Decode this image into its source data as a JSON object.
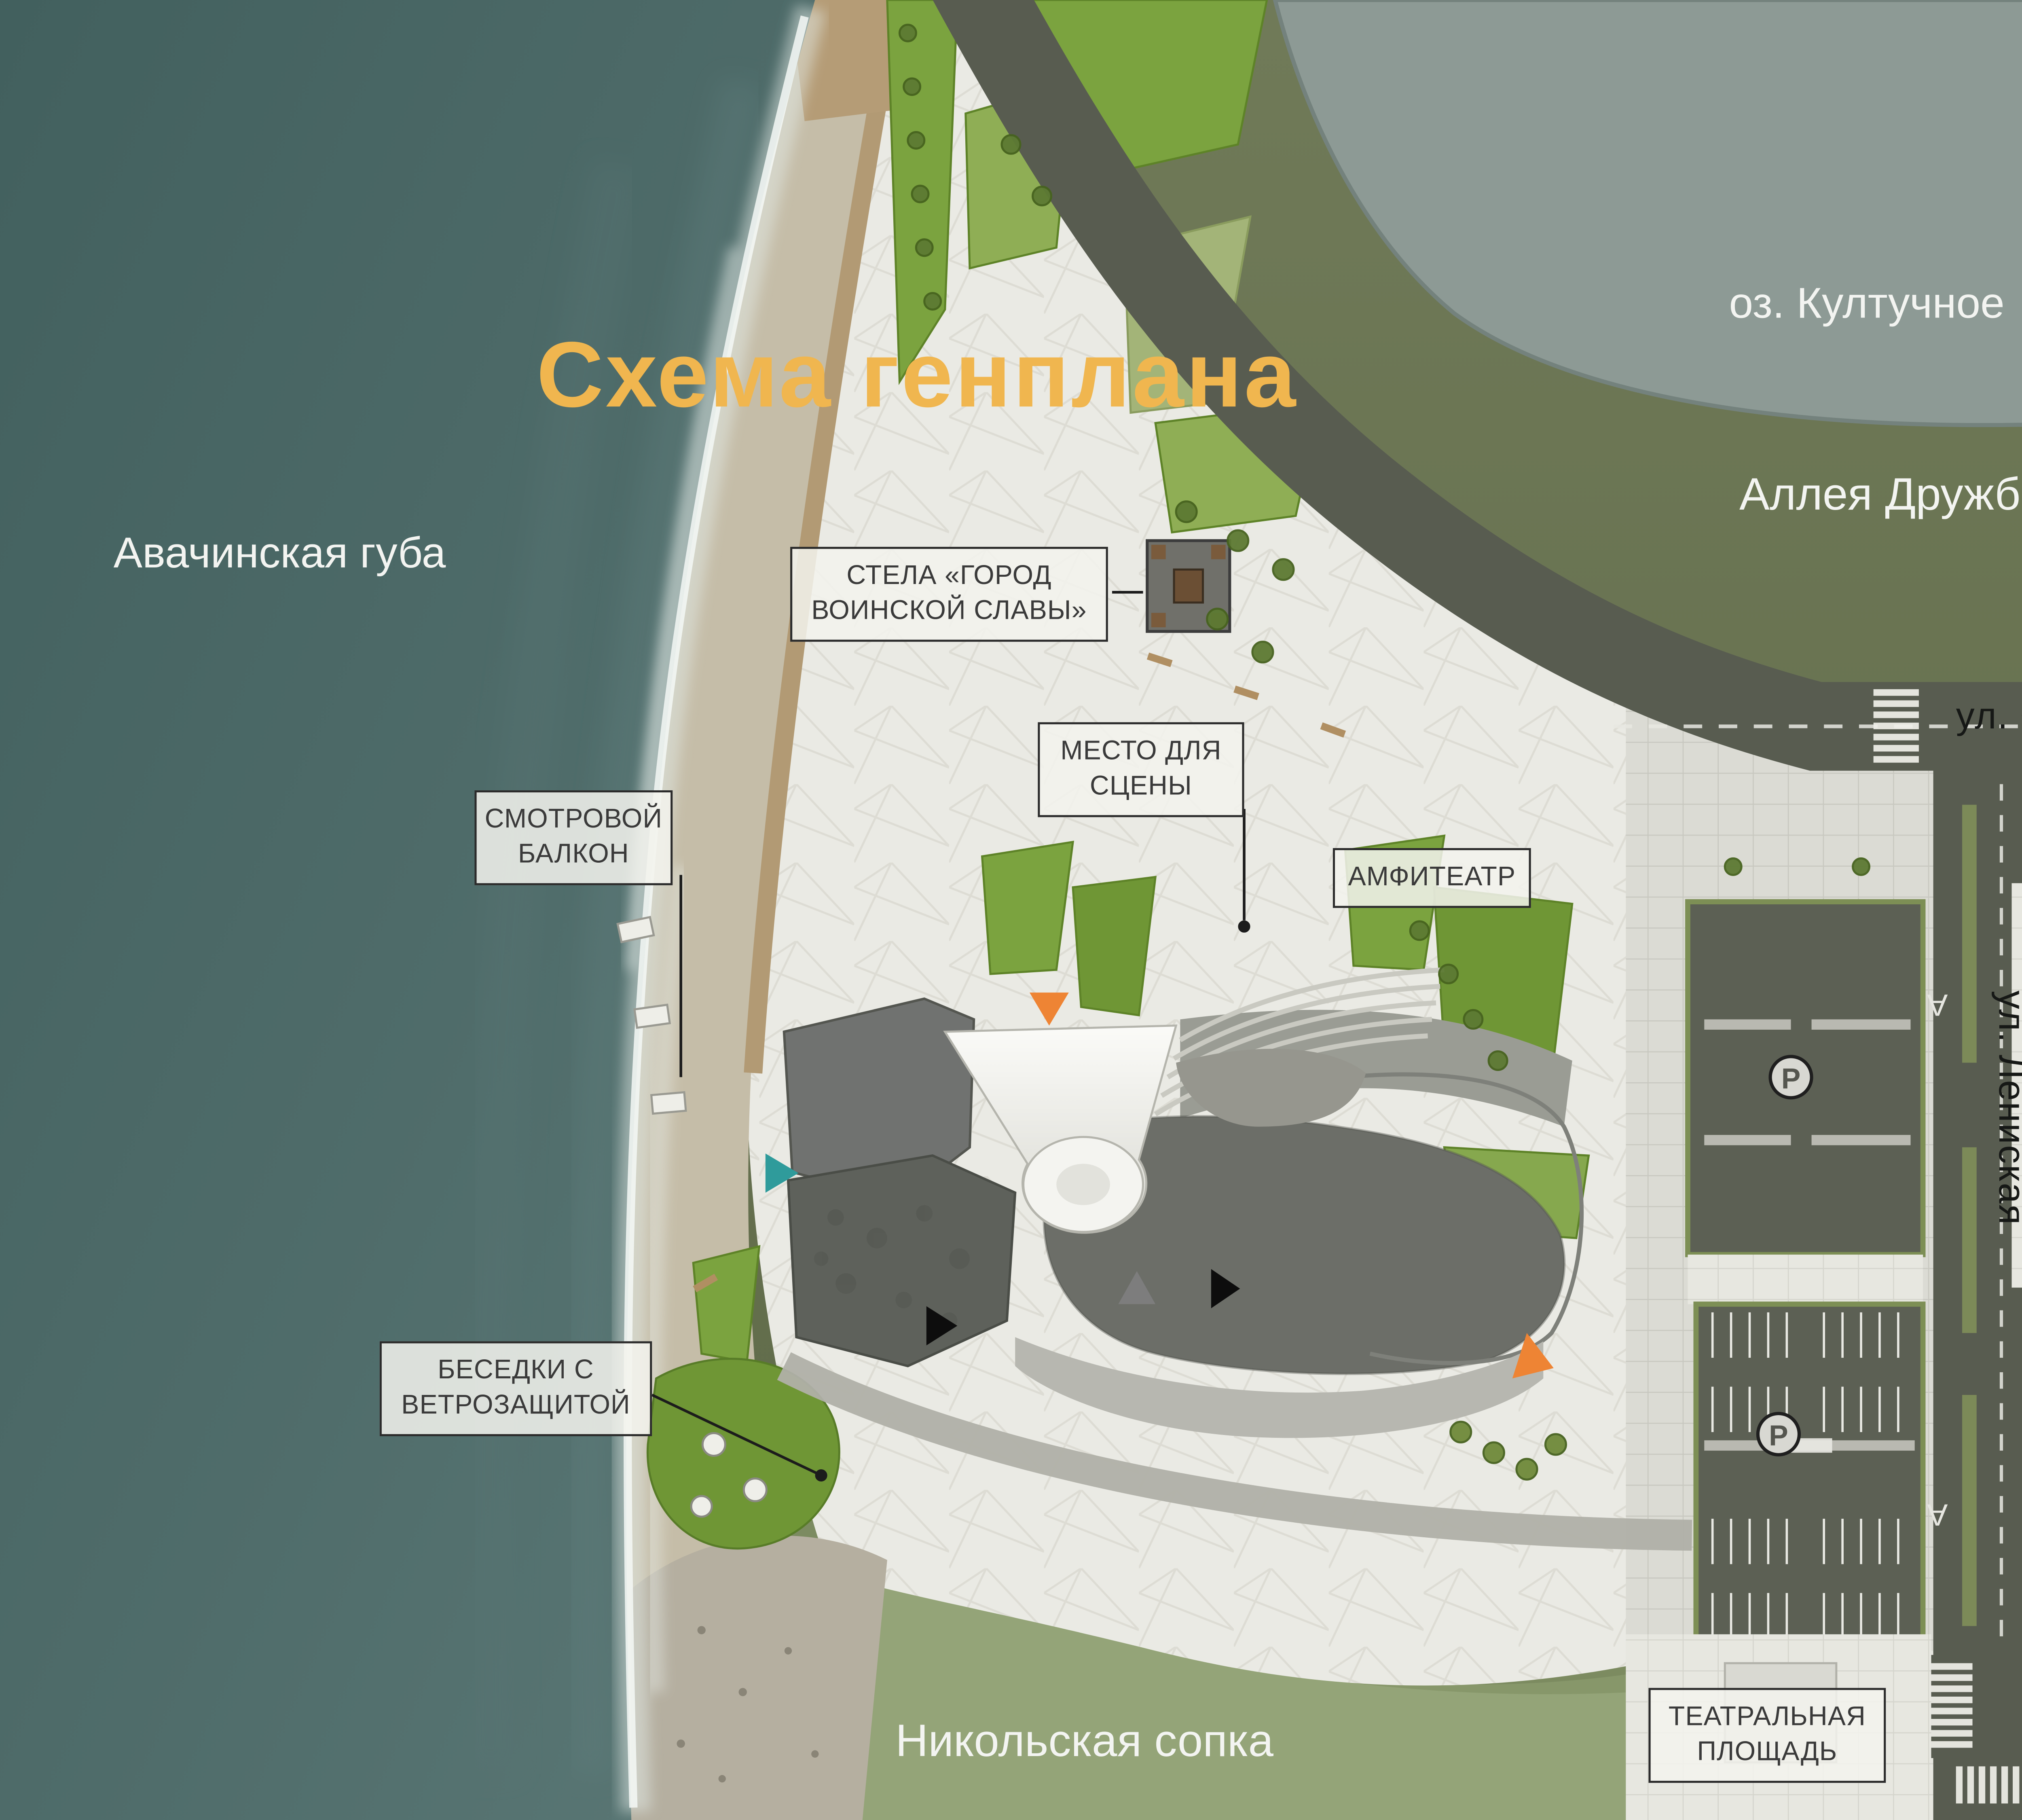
{
  "title": "Схема генплана",
  "compass": {
    "label": "N"
  },
  "areas": {
    "bay": "Авачинская губа",
    "lake": "оз. Култучное",
    "alley": "Аллея Дружбы",
    "hill": "Никольская сопка"
  },
  "streets": {
    "ozernovskaya": "ул. Озерновская Коса",
    "naberezhnaya": "Набережная ул.",
    "leninskaya": "ул. Лениская",
    "road_marking": "A"
  },
  "callouts": {
    "stela": "СТЕЛА «ГОРОД ВОИНСКОЙ СЛАВЫ»",
    "stage": "МЕСТО ДЛЯ СЦЕНЫ",
    "amphitheater": "АМФИТЕАТР",
    "balcony": "СМОТРОВОЙ БАЛКОН",
    "gazebos": "БЕСЕДКИ С ВЕТРОЗАЩИТОЙ",
    "lenin": "ПАМЯТНИК ЛЕНИНУ",
    "government": "ПРАВИТЕЛЬСТВО КРАЯ",
    "theater_square": "ТЕАТРАЛЬНАЯ ПЛОЩАДЬ"
  },
  "markers": {
    "parking": "P"
  },
  "legend": {
    "items": [
      {
        "label": "Основной вход",
        "color": "#ee8434"
      },
      {
        "label": "Вход в ресторан",
        "color": "#2f9b9b"
      },
      {
        "label": "Зона загрузки",
        "color": "#0d0d0d"
      },
      {
        "label": "Вход для персонала",
        "color": "#7d7d7d"
      }
    ]
  },
  "colors": {
    "title_accent": "#f0b64f",
    "ocean": "#4e6a68",
    "sand": "#c5bda8",
    "plaza": "#eaeae4",
    "grass_bright": "#7ba33f",
    "olive": "#6d7856",
    "hill_green": "#94a478",
    "lake": "#8d9a95",
    "road": "#585c50",
    "building": "#6c6e68",
    "legend_bg": "#e9e9e4"
  }
}
